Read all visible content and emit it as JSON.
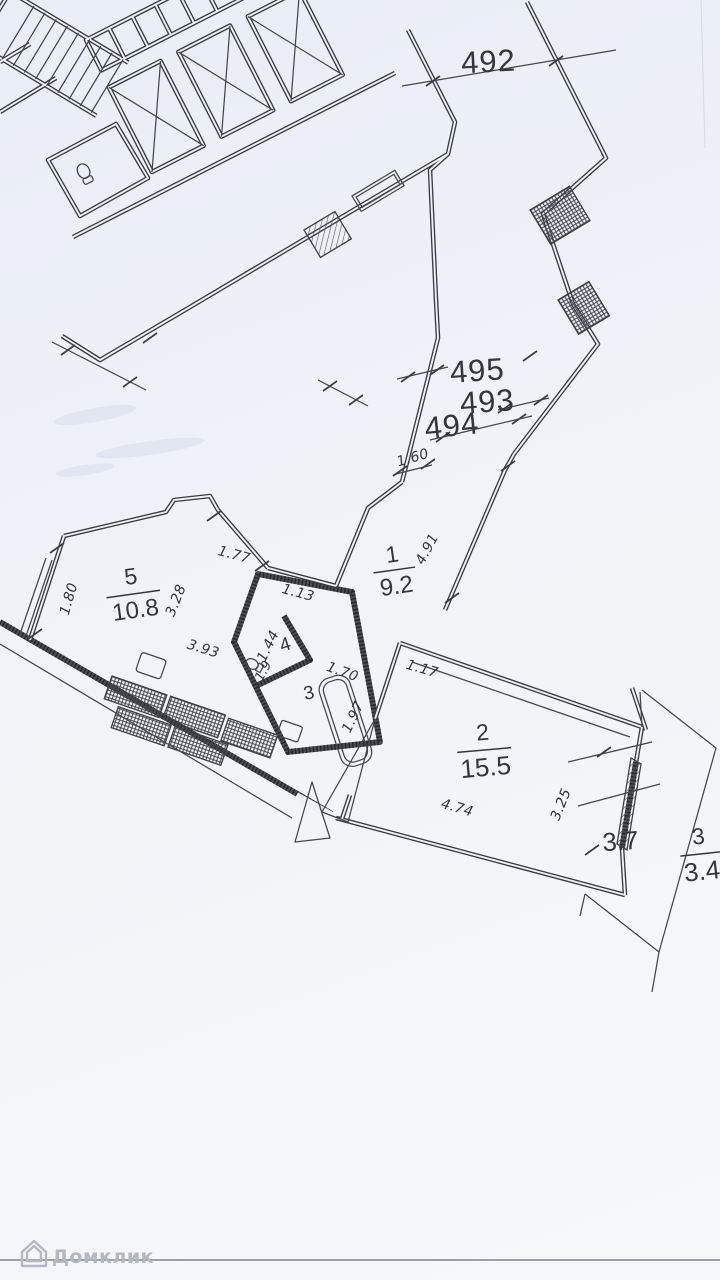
{
  "plan": {
    "reference_numbers": {
      "top": "492",
      "corridor": [
        "495",
        "493",
        "494"
      ]
    },
    "rooms": [
      {
        "number": "1",
        "area": "9.2"
      },
      {
        "number": "2",
        "area": "15.5"
      },
      {
        "number": "3"
      },
      {
        "number": "4",
        "area": "1.9"
      },
      {
        "number": "5",
        "area": "10.8"
      }
    ],
    "balcony": {
      "number": "3",
      "area_full": "3.7",
      "area_reduced": "3.4"
    },
    "dimensions": {
      "corridor_end": "1.60",
      "hallway_length": "4.91",
      "hall_door": "1.13",
      "room5_top_edge": "1.77",
      "room5_left": "1.80",
      "room5_width": "3.28",
      "room5_length": "3.93",
      "room4_width": "1.44",
      "bathtub_length": "1.70",
      "bathroom_side": "1.97",
      "room2_doorway": "1.17",
      "room2_length": "4.74",
      "balcony_window": "3.25"
    },
    "colors": {
      "line": "#3c3d42",
      "paper": "#eef1f6",
      "watermark": "#b4b8c2"
    }
  },
  "watermark": {
    "brand": "Домклик"
  }
}
